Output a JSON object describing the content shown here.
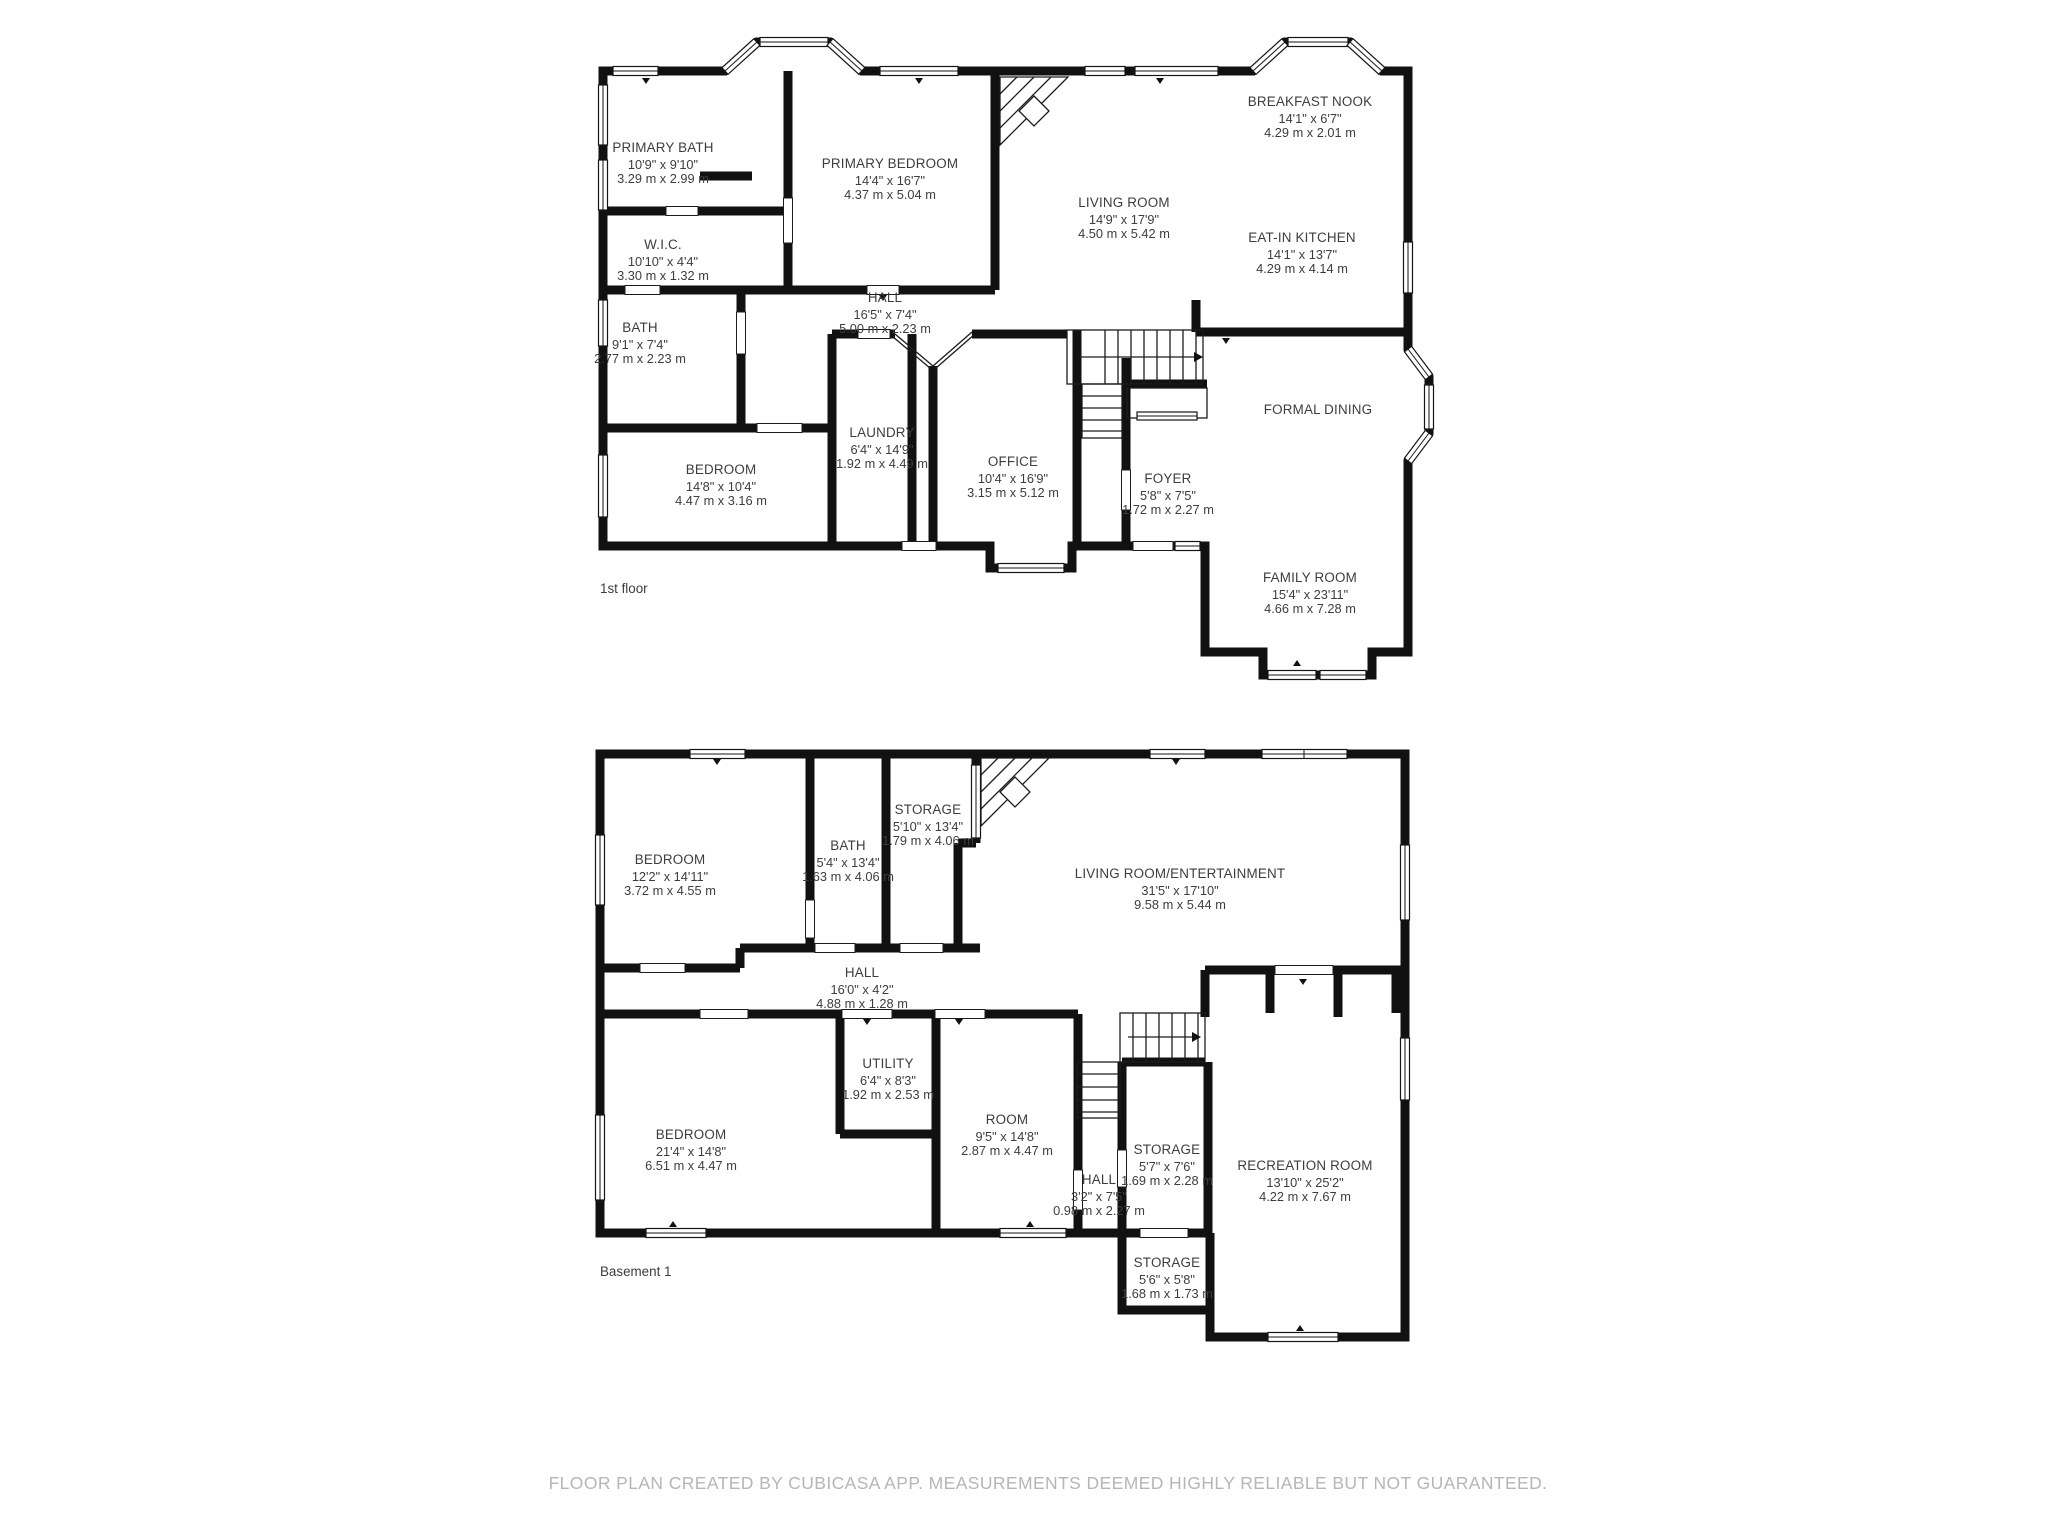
{
  "footer": "FLOOR PLAN CREATED BY CUBICASA APP. MEASUREMENTS DEEMED HIGHLY RELIABLE BUT NOT GUARANTEED.",
  "colors": {
    "wall": "#111111",
    "room_text": "#3d3d3d",
    "footer_text": "#b6b6b6"
  },
  "floors": [
    {
      "label": "1st floor",
      "rooms": [
        {
          "name": "PRIMARY BATH",
          "imperial": "10'9\" x 9'10\"",
          "metric": "3.29 m x 2.99 m"
        },
        {
          "name": "W.I.C.",
          "imperial": "10'10\" x 4'4\"",
          "metric": "3.30 m x 1.32 m"
        },
        {
          "name": "BATH",
          "imperial": "9'1\" x 7'4\"",
          "metric": "2.77 m x 2.23 m"
        },
        {
          "name": "PRIMARY BEDROOM",
          "imperial": "14'4\" x 16'7\"",
          "metric": "4.37 m x 5.04 m"
        },
        {
          "name": "LIVING ROOM",
          "imperial": "14'9\" x 17'9\"",
          "metric": "4.50 m x 5.42 m"
        },
        {
          "name": "BREAKFAST NOOK",
          "imperial": "14'1\" x 6'7\"",
          "metric": "4.29 m x 2.01 m"
        },
        {
          "name": "EAT-IN KITCHEN",
          "imperial": "14'1\" x 13'7\"",
          "metric": "4.29 m x 4.14 m"
        },
        {
          "name": "HALL",
          "imperial": "16'5\" x 7'4\"",
          "metric": "5.00 m x 2.23 m"
        },
        {
          "name": "LAUNDRY",
          "imperial": "6'4\" x 14'9\"",
          "metric": "1.92 m x 4.49 m"
        },
        {
          "name": "OFFICE",
          "imperial": "10'4\" x 16'9\"",
          "metric": "3.15 m x 5.12 m"
        },
        {
          "name": "BEDROOM",
          "imperial": "14'8\" x 10'4\"",
          "metric": "4.47 m x 3.16 m"
        },
        {
          "name": "FOYER",
          "imperial": "5'8\" x 7'5\"",
          "metric": "1.72 m x 2.27 m"
        },
        {
          "name": "FORMAL DINING"
        },
        {
          "name": "FAMILY ROOM",
          "imperial": "15'4\" x 23'11\"",
          "metric": "4.66 m x 7.28 m"
        }
      ]
    },
    {
      "label": "Basement 1",
      "rooms": [
        {
          "name": "BEDROOM",
          "imperial": "12'2\" x 14'11\"",
          "metric": "3.72 m x 4.55 m"
        },
        {
          "name": "BATH",
          "imperial": "5'4\" x 13'4\"",
          "metric": "1.63 m x 4.06 m"
        },
        {
          "name": "STORAGE",
          "imperial": "5'10\" x 13'4\"",
          "metric": "1.79 m x 4.06 m"
        },
        {
          "name": "LIVING ROOM/ENTERTAINMENT",
          "imperial": "31'5\" x 17'10\"",
          "metric": "9.58 m x 5.44 m"
        },
        {
          "name": "HALL",
          "imperial": "16'0\" x 4'2\"",
          "metric": "4.88 m x 1.28 m"
        },
        {
          "name": "UTILITY",
          "imperial": "6'4\" x 8'3\"",
          "metric": "1.92 m x 2.53 m"
        },
        {
          "name": "BEDROOM",
          "imperial": "21'4\" x 14'8\"",
          "metric": "6.51 m x 4.47 m"
        },
        {
          "name": "ROOM",
          "imperial": "9'5\" x 14'8\"",
          "metric": "2.87 m x 4.47 m"
        },
        {
          "name": "STORAGE",
          "imperial": "5'7\" x 7'6\"",
          "metric": "1.69 m x 2.28 m"
        },
        {
          "name": "HALL",
          "imperial": "3'2\" x 7'5\"",
          "metric": "0.98 m x 2.27 m"
        },
        {
          "name": "STORAGE",
          "imperial": "5'6\" x 5'8\"",
          "metric": "1.68 m x 1.73 m"
        },
        {
          "name": "RECREATION ROOM",
          "imperial": "13'10\" x 25'2\"",
          "metric": "4.22 m x 7.67 m"
        }
      ]
    }
  ]
}
